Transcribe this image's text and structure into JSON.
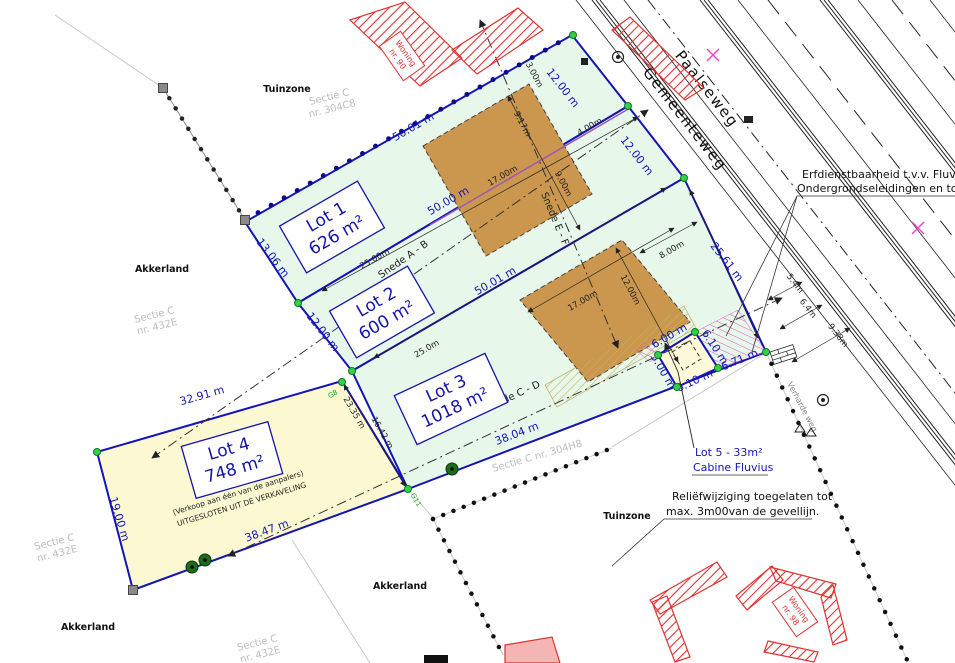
{
  "lots": [
    {
      "label": "Lot 1",
      "area": "626 m²"
    },
    {
      "label": "Lot 2",
      "area": "600 m²"
    },
    {
      "label": "Lot 3",
      "area": "1018 m²"
    },
    {
      "label": "Lot 4",
      "area": "748 m²",
      "note1": "(Verkoop aan één van de aanpalers)",
      "note2": "UITGESLOTEN UIT DE VERKAVELING"
    }
  ],
  "roads": {
    "paalseweg": "Paalseweg",
    "gemeenteweg": "Gemeenteweg",
    "side_road": "Verharde weg"
  },
  "zones": {
    "tuinzone": "Tuinzone",
    "akkerland": "Akkerland"
  },
  "sections": {
    "c304c8_1": "Sectie C",
    "c304c8_2": "nr. 304C8",
    "c432e_1": "Sectie C",
    "c432e_2": "nr. 432E",
    "c304h8": "Sectie C nr. 304H8"
  },
  "buildings": {
    "woning_top_1": "Woning",
    "woning_top_2": "nr. 90",
    "woning_bottom_1": "Woning",
    "woning_bottom_2": "nr. 98"
  },
  "snede": {
    "ab": "Snede A - B",
    "cd": "Snede C - D",
    "ef": "Snede E - F"
  },
  "survey": {
    "g8": "G8",
    "g11": "G11"
  },
  "annotations": {
    "erf_line1": "Erfdienstbaarheid t.v.v. Fluvius",
    "erf_line2": "Ondergrondseleidingen en toegang o",
    "lot5_line1": "Lot 5 - 33m²",
    "lot5_line2": "Cabine Fluvius",
    "relief_line1": "Reliëfwijziging toegelaten tot",
    "relief_line2": "max. 3m00van de gevellijn."
  },
  "dims": {
    "top_5001": "50.01 m",
    "b12_5000": "50.00 m",
    "b23_5001": "50.01 m",
    "l1_front": "12.00 m",
    "l2_front": "12.00 m",
    "l1_left": "13.06 m",
    "l2_left": "12.00 m",
    "l3_front": "25.61 m",
    "d2335": "23.35 m",
    "d1642": "16.42 m",
    "d3291": "32.91 m",
    "d1900": "19.00 m",
    "d3847": "38.47 m",
    "d3804": "38.04 m",
    "d600": "6.00 m",
    "d500": "5.00 m",
    "d610a": "6.10 m",
    "d610b": "6.10 m",
    "d671": "6.71 m",
    "d54": "5.4m",
    "d64": "6.4m",
    "d938": "9.38m",
    "d800": "8.00m",
    "d917": "9.17m",
    "d900": "9.00m",
    "d1700a": "17.00m",
    "d1700b": "17.00m",
    "d1200z": "12.00m",
    "d400": "4.00m",
    "d300": "3.00m",
    "d2500": "25.00m",
    "d250": "25.0m"
  },
  "colors": {
    "lot_green": "#e7f7ea",
    "lot_yellow": "#fbf8d2",
    "building_zone": "#cb964e",
    "boundary_blue": "#1414b4",
    "dim_blue": "#1616b6",
    "hatch_red": "#e03232",
    "hatch_pink": "#e054c8",
    "survey_green": "#35d04a"
  }
}
